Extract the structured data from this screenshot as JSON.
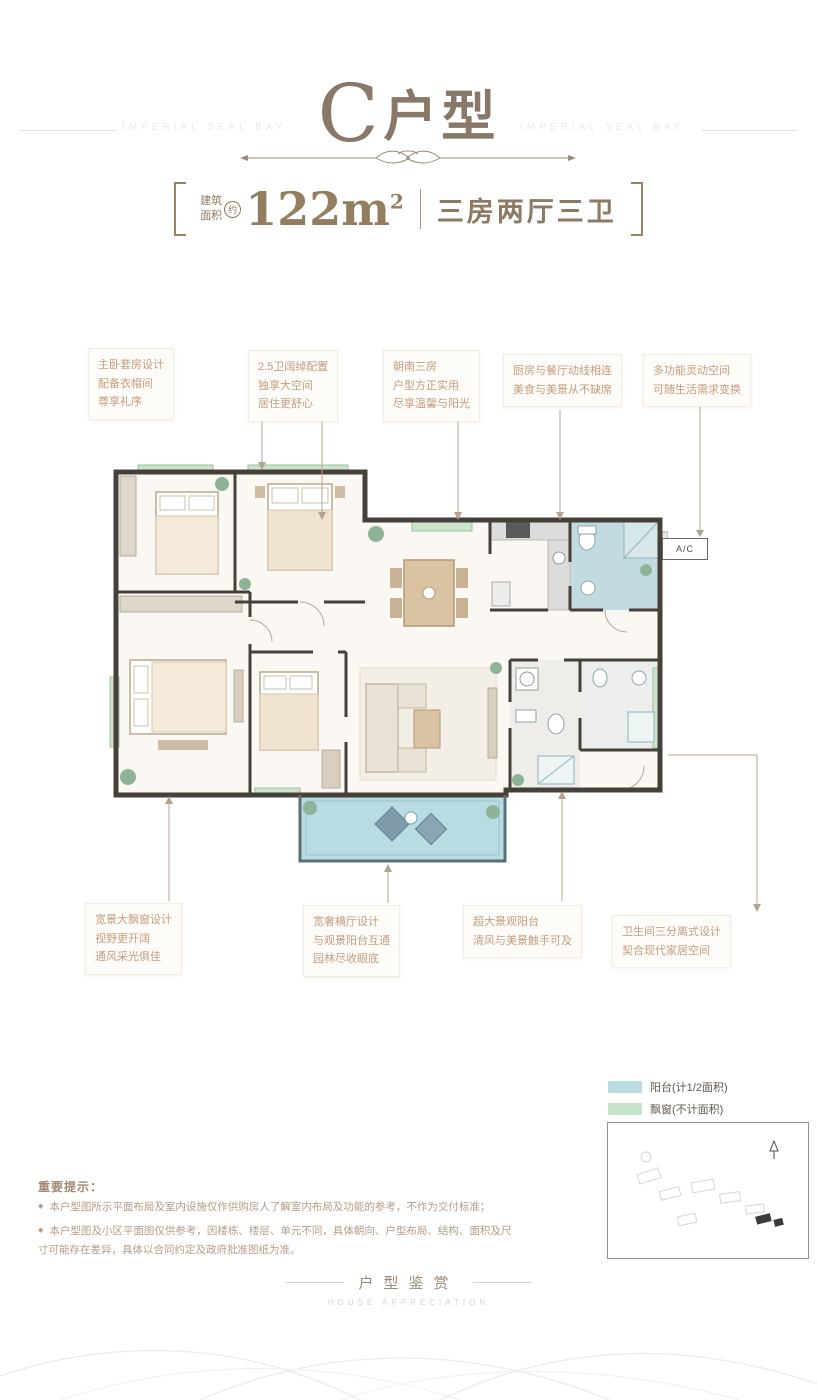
{
  "header": {
    "brand_left": "IMPERIAL SEAL BAY",
    "brand_right": "IMPERIAL SEAL BAY",
    "title_letter": "C",
    "title_suffix": "户型",
    "area_label_line1": "建筑",
    "area_label_line2": "面积",
    "area_approx": "约",
    "area_value": "122m",
    "area_sup": "2",
    "layout_text": "三房两厅三卫"
  },
  "callouts_top": [
    {
      "lines": [
        "主卧套房设计",
        "配备衣帽间",
        "尊享礼序"
      ]
    },
    {
      "lines": [
        "2.5卫阔绰配置",
        "独享大空间",
        "居住更舒心"
      ]
    },
    {
      "lines": [
        "朝南三房",
        "户型方正实用",
        "尽享温馨与阳光"
      ]
    },
    {
      "lines": [
        "厨房与餐厅动线相连",
        "美食与美景从不缺席"
      ]
    },
    {
      "lines": [
        "多功能灵动空间",
        "可随生活需求变换"
      ]
    }
  ],
  "callouts_bottom": [
    {
      "lines": [
        "宽景大飘窗设计",
        "视野更开阔",
        "通风采光俱佳"
      ]
    },
    {
      "lines": [
        "宽奢横厅设计",
        "与观景阳台互通",
        "园林尽收眼底"
      ]
    },
    {
      "lines": [
        "超大景观阳台",
        "清风与美景触手可及"
      ]
    },
    {
      "lines": [
        "卫生间三分离式设计",
        "契合现代家居空间"
      ]
    }
  ],
  "plan": {
    "ac_label": "A/C"
  },
  "legend": [
    {
      "color": "#b9dce3",
      "label": "阳台(计1/2面积)"
    },
    {
      "color": "#c9e2cc",
      "label": "飘窗(不计面积)"
    }
  ],
  "disclaimer": {
    "heading": "重要提示：",
    "bullet": "◆",
    "items": [
      "本户型图所示平面布局及室内设施仅作供购房人了解室内布局及功能的参考，不作为交付标准；",
      "本户型图及小区平面图仅供参考，因楼栋、楼层、单元不同，具体朝向、户型布局、结构、面积及尺寸可能存在差异，具体以合同约定及政府批准图纸为准。"
    ]
  },
  "footer": {
    "title": "户型鉴赏",
    "subtitle": "HOUSE APPRECIATION"
  }
}
